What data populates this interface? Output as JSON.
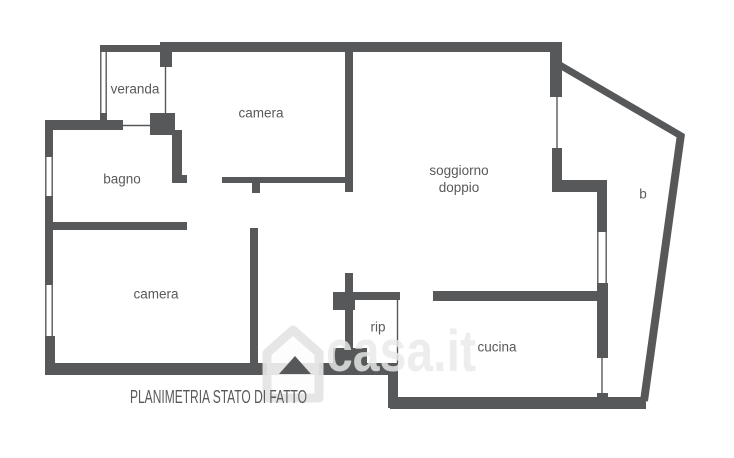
{
  "plan": {
    "caption": "PLANIMETRIA STATO DI FATTO",
    "watermark": {
      "brand": "casa.it",
      "icon": "casa-house-logo"
    },
    "rooms": [
      {
        "name": "veranda",
        "label": "veranda"
      },
      {
        "name": "camera-top",
        "label": "camera"
      },
      {
        "name": "bagno",
        "label": "bagno"
      },
      {
        "name": "soggiorno-doppio",
        "label": "soggiorno doppio"
      },
      {
        "name": "camera-bottom",
        "label": "camera"
      },
      {
        "name": "ripostiglio",
        "label": "rip"
      },
      {
        "name": "cucina",
        "label": "cucina"
      },
      {
        "name": "balcone",
        "label": "b"
      }
    ],
    "colors": {
      "wall": "#57585a",
      "label": "#58595b",
      "background": "#ffffff",
      "watermark": "#e9e9e9"
    }
  }
}
